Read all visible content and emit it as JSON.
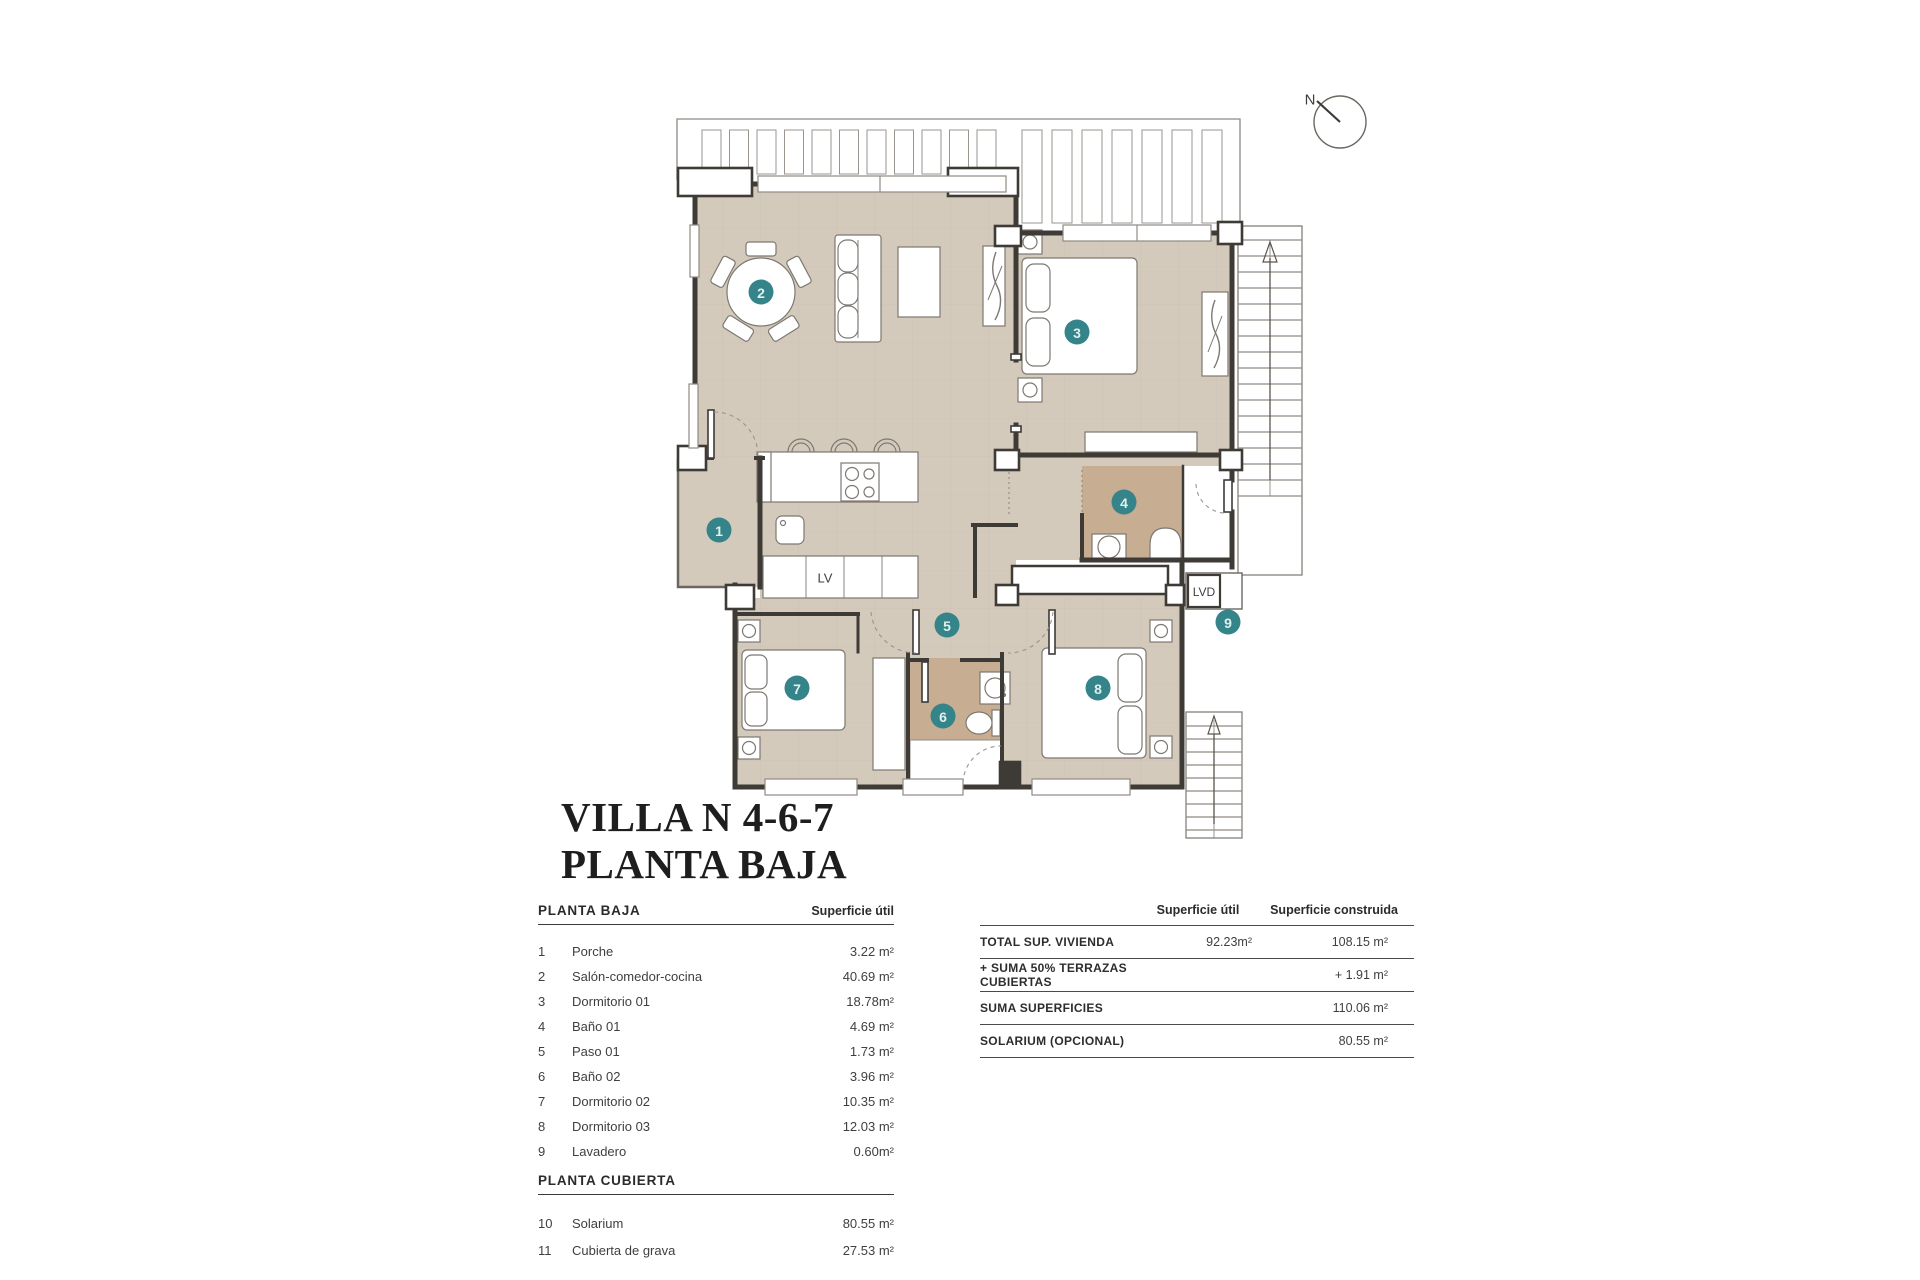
{
  "title": {
    "line1": "VILLA N 4-6-7",
    "line2": "PLANTA BAJA"
  },
  "plan": {
    "north_label": "N",
    "badges": [
      "1",
      "2",
      "3",
      "4",
      "5",
      "6",
      "7",
      "8",
      "9"
    ],
    "labels": {
      "lv": "LV",
      "lvd": "LVD"
    },
    "colors": {
      "floor": "#d4cabc",
      "bath_floor": "#c7ad92",
      "wall": "#3e3a36",
      "badge": "#34848a",
      "thin_line": "#8f8a84"
    }
  },
  "left_table": {
    "sections": [
      {
        "header": "PLANTA BAJA",
        "col_header": "Superficie útil",
        "rows": [
          {
            "num": "1",
            "name": "Porche",
            "value": "3.22 m²"
          },
          {
            "num": "2",
            "name": "Salón-comedor-cocina",
            "value": "40.69 m²"
          },
          {
            "num": "3",
            "name": "Dormitorio 01",
            "value": "18.78m²"
          },
          {
            "num": "4",
            "name": "Baño 01",
            "value": "4.69 m²"
          },
          {
            "num": "5",
            "name": "Paso 01",
            "value": "1.73 m²"
          },
          {
            "num": "6",
            "name": "Baño 02",
            "value": "3.96 m²"
          },
          {
            "num": "7",
            "name": "Dormitorio 02",
            "value": "10.35 m²"
          },
          {
            "num": "8",
            "name": "Dormitorio 03",
            "value": "12.03 m²"
          },
          {
            "num": "9",
            "name": "Lavadero",
            "value": "0.60m²"
          }
        ]
      },
      {
        "header": "PLANTA CUBIERTA",
        "rows": [
          {
            "num": "10",
            "name": "Solarium",
            "value": "80.55 m²"
          },
          {
            "num": "11",
            "name": "Cubierta de grava",
            "value": "27.53 m²"
          }
        ]
      }
    ]
  },
  "right_table": {
    "col1": "Superficie útil",
    "col2": "Superficie construida",
    "rows": [
      {
        "label": "TOTAL SUP. VIVIENDA",
        "util": "92.23m²",
        "construida": "108.15 m²"
      },
      {
        "label": "+ SUMA 50% TERRAZAS CUBIERTAS",
        "util": "",
        "construida": "+ 1.91 m²"
      },
      {
        "label": "SUMA SUPERFICIES",
        "util": "",
        "construida": "110.06 m²"
      },
      {
        "label": "SOLARIUM (OPCIONAL)",
        "util": "",
        "construida": "80.55 m²"
      }
    ]
  }
}
